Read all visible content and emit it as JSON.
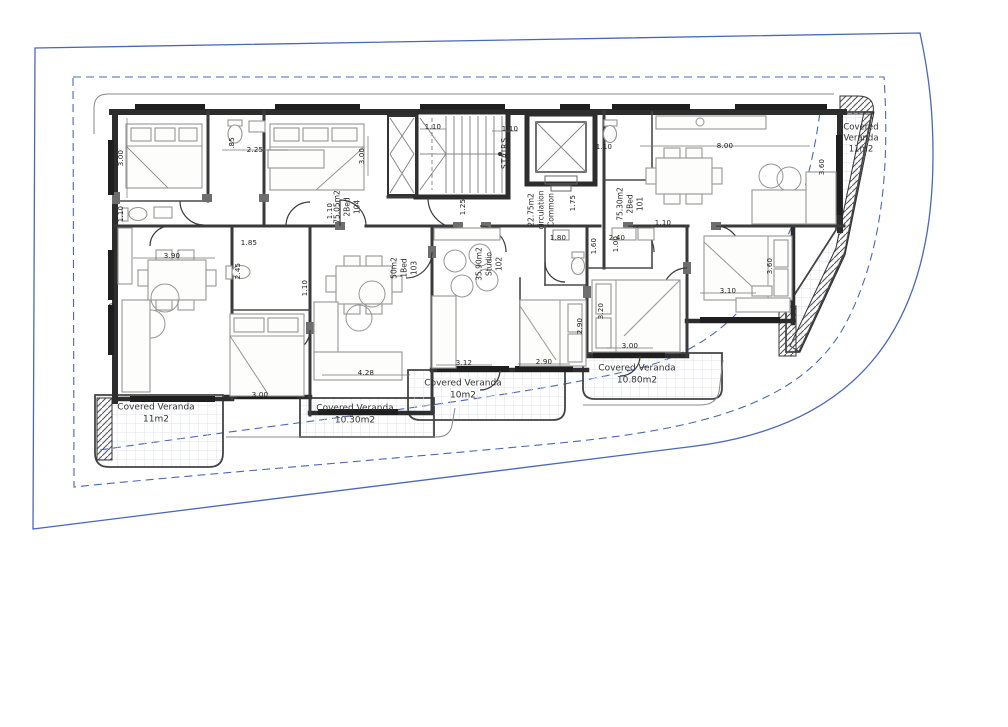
{
  "drawing": {
    "units": [
      {
        "number": "104",
        "type": "2Bed",
        "area": "75.05m2"
      },
      {
        "number": "103",
        "type": "1Bed",
        "area": "50m2"
      },
      {
        "number": "102",
        "type": "Studio",
        "area": "35.90m2"
      },
      {
        "number": "101",
        "type": "2Bed",
        "area": "75.30m2"
      }
    ],
    "common_area": {
      "line1": "Common",
      "line2": "circulation",
      "area": "22.75m2"
    },
    "stairs_label": "STAIRS",
    "verandas": [
      {
        "position": "right",
        "line1": "Covered",
        "line2": "Veranda",
        "area": "11m2"
      },
      {
        "position": "bottom-left",
        "label": "Covered Veranda",
        "area": "11m2"
      },
      {
        "position": "bottom-center-left",
        "label": "Covered Veranda",
        "area": "10.30m2"
      },
      {
        "position": "bottom-center",
        "label": "Covered Veranda",
        "area": "10m2"
      },
      {
        "position": "bottom-right",
        "label": "Covered Veranda",
        "area": "10.80m2"
      }
    ],
    "dimensions": [
      "3.00",
      "1.10",
      ".85",
      "2.25",
      "3.00",
      "1.10",
      "1.10",
      "1.10",
      "1.25",
      "1.75",
      "1.10",
      "8.00",
      "3.60",
      "3.90",
      "1.85",
      "2.45",
      "1.10",
      "1.00",
      "1.80",
      "2.40",
      "1.10",
      "1.60",
      "1.00",
      "4.28",
      "3.00",
      "3.12",
      "2.90",
      "2.90",
      "3.20",
      "3.00",
      "3.10",
      "3.60"
    ],
    "colors": {
      "boundary_blue": "#4a68b8",
      "wall_dark": "#2d2d2d",
      "furniture_gray": "#969696",
      "veranda_grid": "#dfe3ee"
    }
  }
}
